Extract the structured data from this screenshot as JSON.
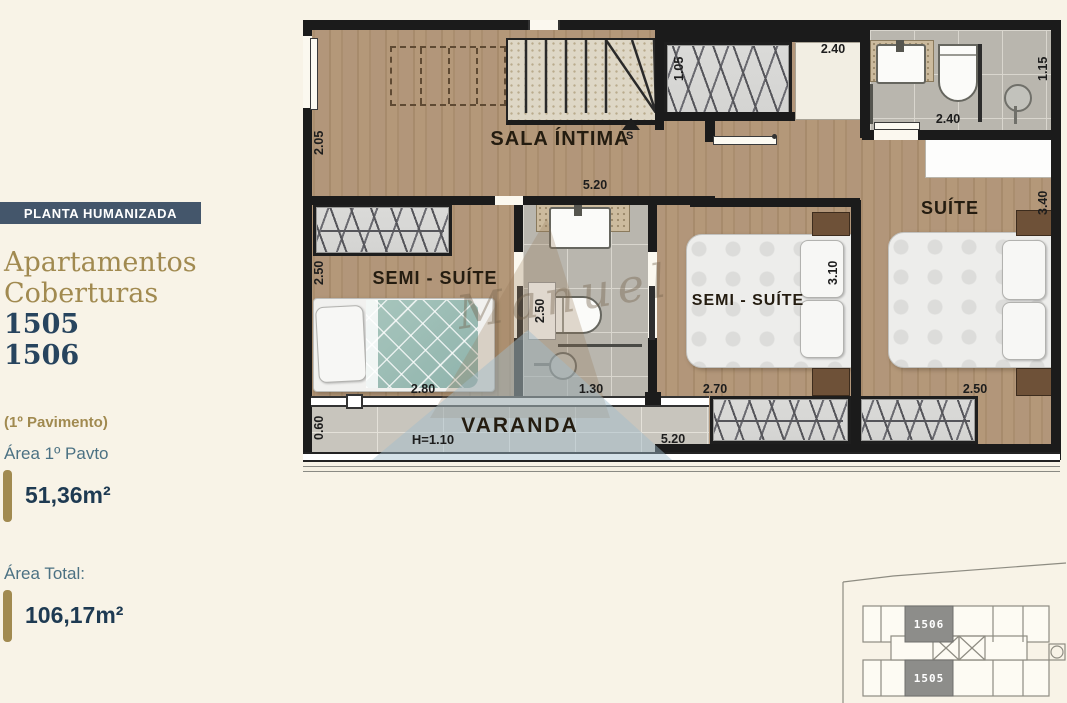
{
  "sidebar": {
    "badge": "PLANTA HUMANIZADA",
    "title_line1": "Apartamentos",
    "title_line2": "Coberturas",
    "unit_numbers": [
      "1505",
      "1506"
    ],
    "floor_note": "(1º Pavimento)",
    "area_floor_label": "Área 1º Pavto",
    "area_floor_value": "51,36m²",
    "area_total_label": "Área Total:",
    "area_total_value": "106,17m²",
    "colors": {
      "badge_bg": "#44566b",
      "gold": "#a18a50",
      "navy": "#27445e",
      "teal": "#4b7183"
    }
  },
  "floorplan": {
    "watermark": "Manuel",
    "stair_direction_label": "S",
    "rooms": [
      {
        "name": "SALA ÍNTIMA"
      },
      {
        "name": "SEMI - SUÍTE"
      },
      {
        "name": "SEMI - SUÍTE"
      },
      {
        "name": "SUÍTE"
      },
      {
        "name": "VARANDA"
      }
    ],
    "dimensions": [
      {
        "text": "2.05"
      },
      {
        "text": "5.20"
      },
      {
        "text": "1.05"
      },
      {
        "text": "2.40"
      },
      {
        "text": "2.40"
      },
      {
        "text": "1.15"
      },
      {
        "text": "3.40"
      },
      {
        "text": "2.50"
      },
      {
        "text": "2.80"
      },
      {
        "text": "2.50"
      },
      {
        "text": "1.30"
      },
      {
        "text": "3.10"
      },
      {
        "text": "2.70"
      },
      {
        "text": "2.50"
      },
      {
        "text": "0.60"
      },
      {
        "text": "H=1.10"
      },
      {
        "text": "5.20"
      }
    ]
  },
  "keyplan": {
    "unit_top": "1506",
    "unit_bottom": "1505"
  }
}
